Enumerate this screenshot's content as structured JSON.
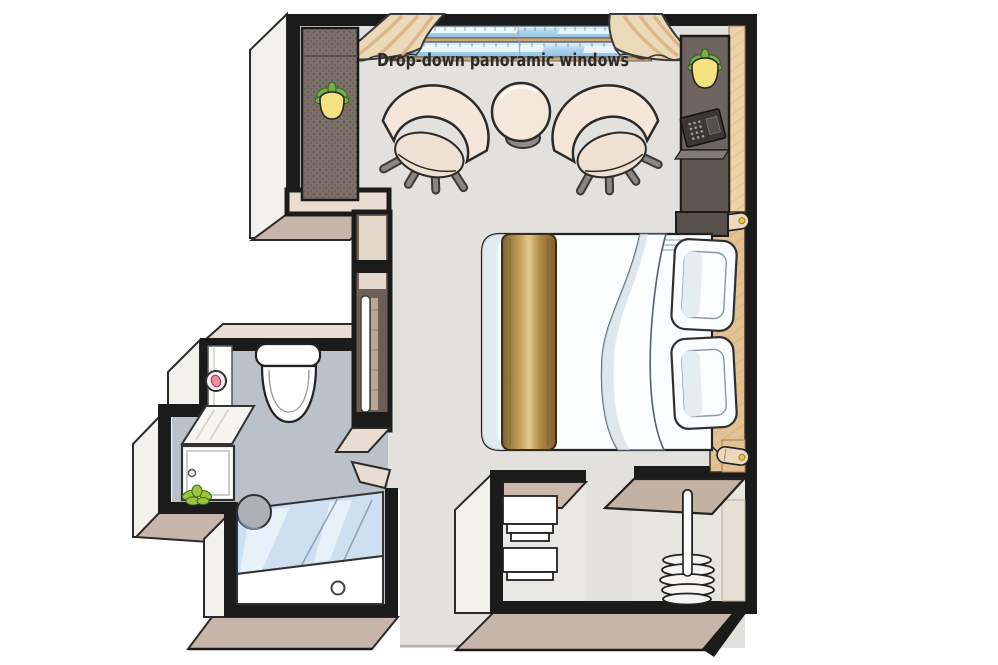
{
  "floorplan": {
    "window_label": "Drop-down panoramic windows",
    "rooms": {
      "cabin": "main cabin",
      "bathroom": "bathroom",
      "wardrobe": "wardrobe closets",
      "entry": "entry corridor"
    },
    "features": [
      "drop-down panoramic windows",
      "curtains",
      "armchair left",
      "armchair right",
      "round side table",
      "double bed",
      "gold bed runner",
      "pillows",
      "wood headboard wall",
      "reading sconces",
      "safe",
      "tall cabinet",
      "nightstand",
      "full-length mirror",
      "toilet",
      "toilet-paper holder",
      "washbasin vanity",
      "shower with glass screen",
      "stool",
      "towel shelves",
      "hanging rail with hangers",
      "potted plants"
    ],
    "colors": {
      "wall_outline": "#1b1b1b",
      "floor": "#e3e1de",
      "bathroom_floor": "#bac1c8",
      "face_taupe": "#c7b5a9",
      "face_beige": "#e9ddd1",
      "face_white": "#f3f1ed",
      "wood_light": "#ecd2a9",
      "wood_headboard": "#e2c193",
      "gold_runner": "#a8854a",
      "window_glass": "#a9d2ec",
      "curtain": "#ecd9b8",
      "curtain_shade": "#d9b488",
      "cabinet_dark": "#6e645f",
      "safe": "#3c3634",
      "plant_green": "#76b043",
      "plant_pot": "#f3e27d",
      "chair_cream": "#f4e7da",
      "shower_glass": "#cddff0"
    }
  }
}
